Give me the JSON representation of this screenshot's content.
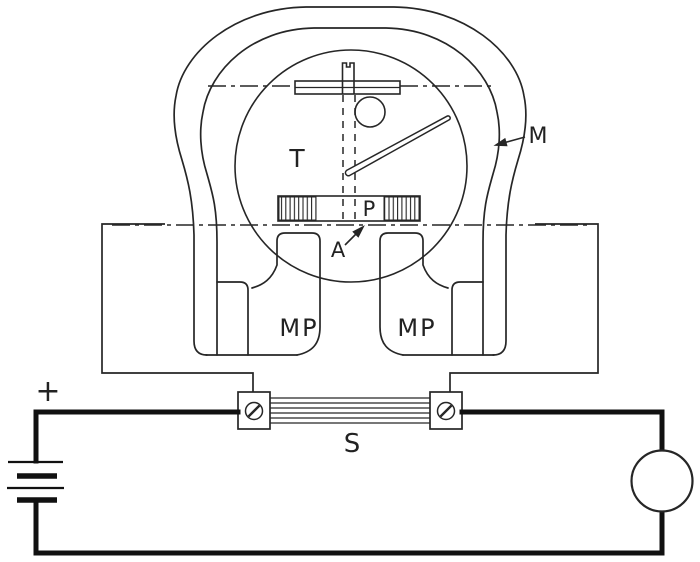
{
  "diagram": {
    "title": "Permanent-magnet instrument with shunt circuit (line drawing)",
    "labels": {
      "m": "M",
      "t": "T",
      "p": "P",
      "a": "A",
      "mp_left": "MP",
      "mp_right": "MP",
      "s": "S",
      "plus": "+"
    },
    "colors": {
      "ink": "#262626",
      "paper": "#ffffff"
    }
  }
}
